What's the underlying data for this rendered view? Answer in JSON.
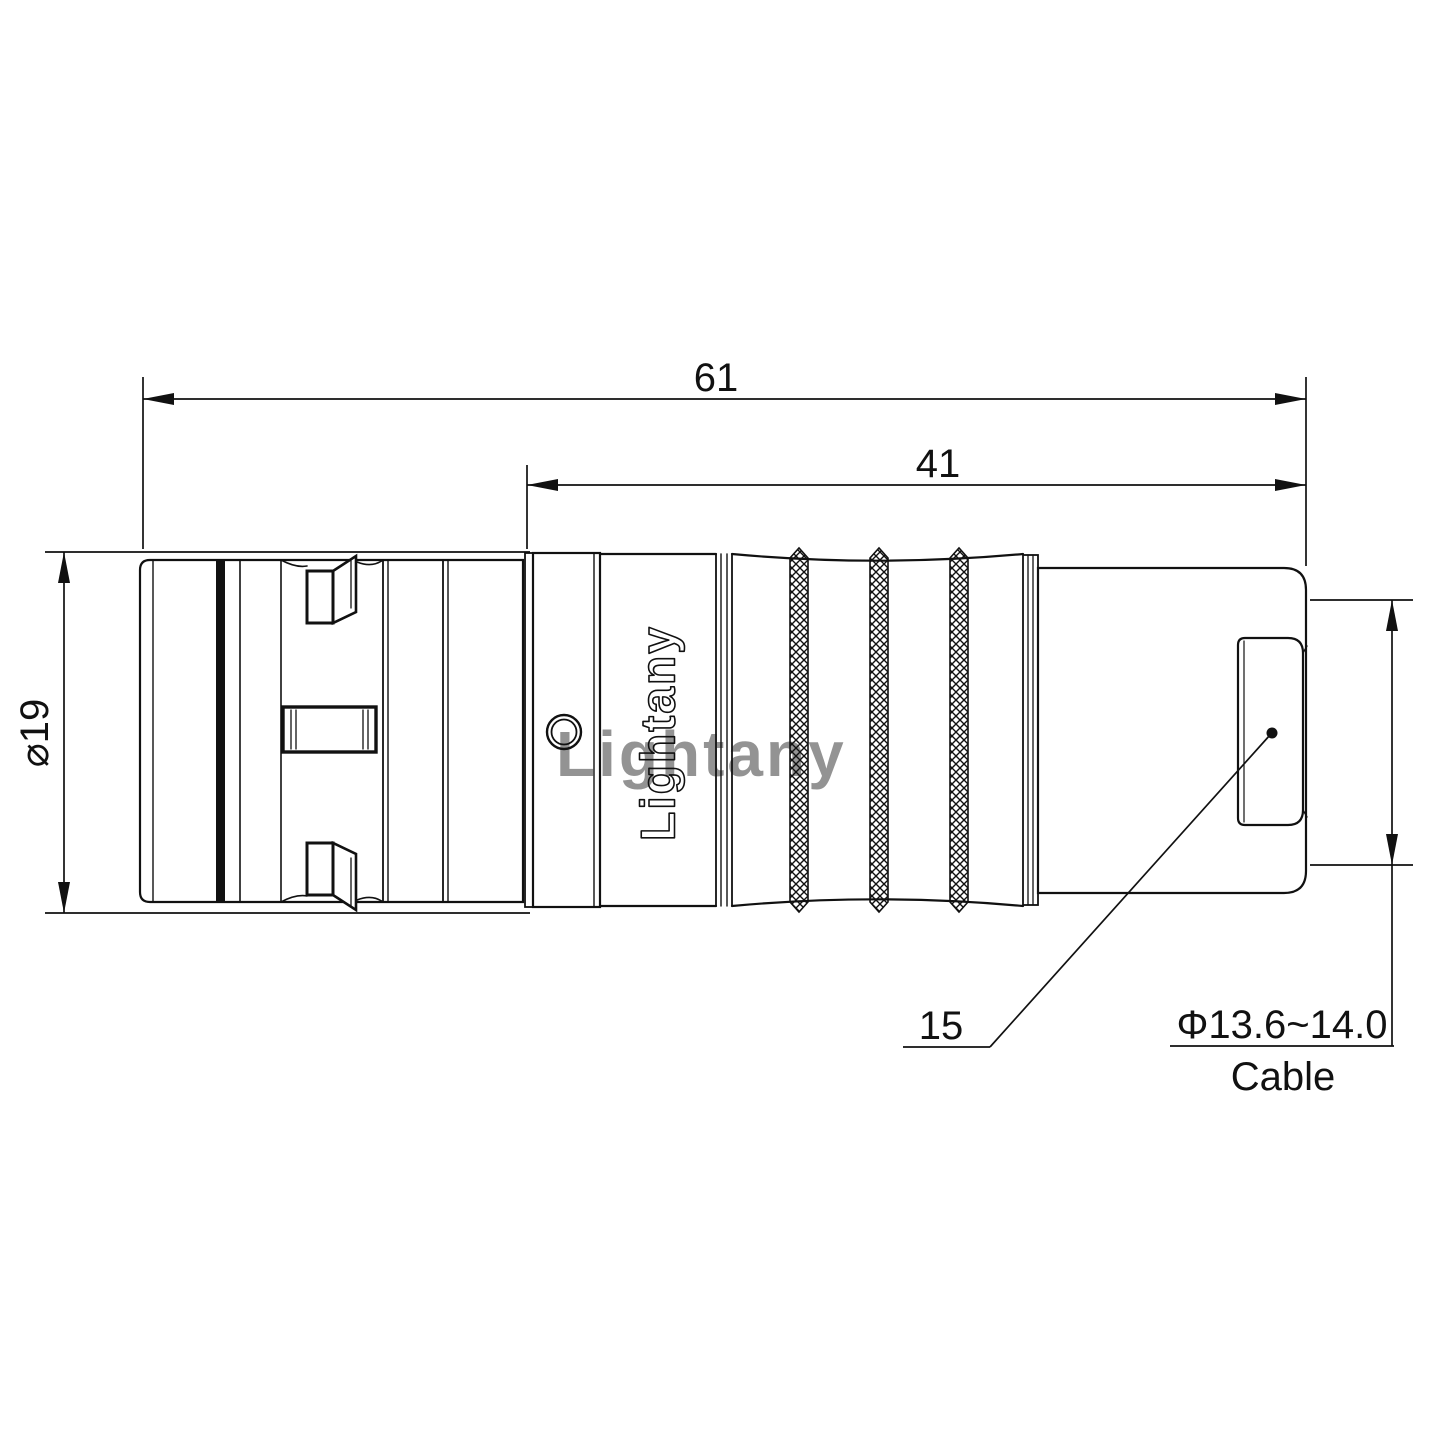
{
  "drawing": {
    "type": "technical-connector-drawing",
    "background": "#ffffff",
    "line_color": "#111111",
    "watermark": {
      "text": "Lightany",
      "color": "#e9a0a0"
    },
    "engraving": {
      "text": "Lightany"
    },
    "dimensions": {
      "overall_length": "61",
      "rear_length": "41",
      "body_diameter": "⌀19",
      "boot_length": "15",
      "cable_diameter": "Φ13.6~14.0",
      "cable_word": "Cable"
    }
  }
}
